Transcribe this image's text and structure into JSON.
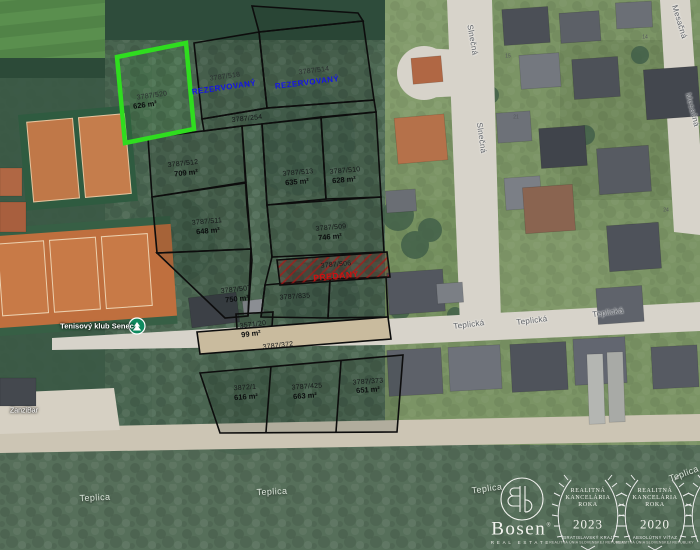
{
  "parcels": [
    {
      "number": "3787/520",
      "area": "626 m²",
      "status_type": "highlighted"
    },
    {
      "number": "3787/518",
      "status": "REZERVOVANÝ"
    },
    {
      "number": "3787/514",
      "status": "REZERVOVANÝ"
    },
    {
      "number": "3787/254"
    },
    {
      "number": "3787/512",
      "area": "709 m²"
    },
    {
      "number": "3787/513",
      "area": "635 m²"
    },
    {
      "number": "3787/510",
      "area": "628 m²"
    },
    {
      "number": "3787/511",
      "area": "648 m²"
    },
    {
      "number": "3787/509",
      "area": "746 m²"
    },
    {
      "number": "3787/506",
      "status": "PREDANÝ"
    },
    {
      "number": "3787/507",
      "area": "750 m²"
    },
    {
      "number": "3787/835"
    },
    {
      "number": "3571/20",
      "area": "99 m²"
    },
    {
      "number": "3787/372"
    },
    {
      "number": "3872/1",
      "area": "616 m²"
    },
    {
      "number": "3787/425",
      "area": "663 m²"
    },
    {
      "number": "3787/373",
      "area": "651 m²"
    }
  ],
  "streets": {
    "slnecna": "Slnečná",
    "teplicka": "Teplická",
    "mesacna": "Mesačná"
  },
  "places": {
    "stream": "Teplica",
    "poi": "Tenisový klub Senec",
    "bar": "ZanziBar"
  },
  "house_numbers": [
    "15",
    "21",
    "14",
    "24"
  ],
  "colors": {
    "highlight_green": "#2fdd1f",
    "reserved_blue": "#1414e6",
    "sold_red": "#cf1111",
    "boundary_black": "#0d0d0d"
  },
  "branding": {
    "name": "Bosen",
    "registered": "®",
    "tagline": "REAL ESTATE",
    "awards": [
      {
        "line1": "REALITNÁ",
        "line2": "KANCELÁRIA",
        "line3": "ROKA",
        "year": "2023",
        "subtitle": "BRATISLAVSKÝ KRAJ",
        "footnote": "REALITNÁ ÚNIA SLOVENSKEJ REPUBLIKY"
      },
      {
        "line1": "REALITNÁ",
        "line2": "KANCELÁRIA",
        "line3": "ROKA",
        "year": "2020",
        "subtitle": "ABSOLÚTNY VÍŤAZ",
        "footnote": "REALITNÁ ÚNIA SLOVENSKEJ REPUBLIKY"
      }
    ]
  }
}
